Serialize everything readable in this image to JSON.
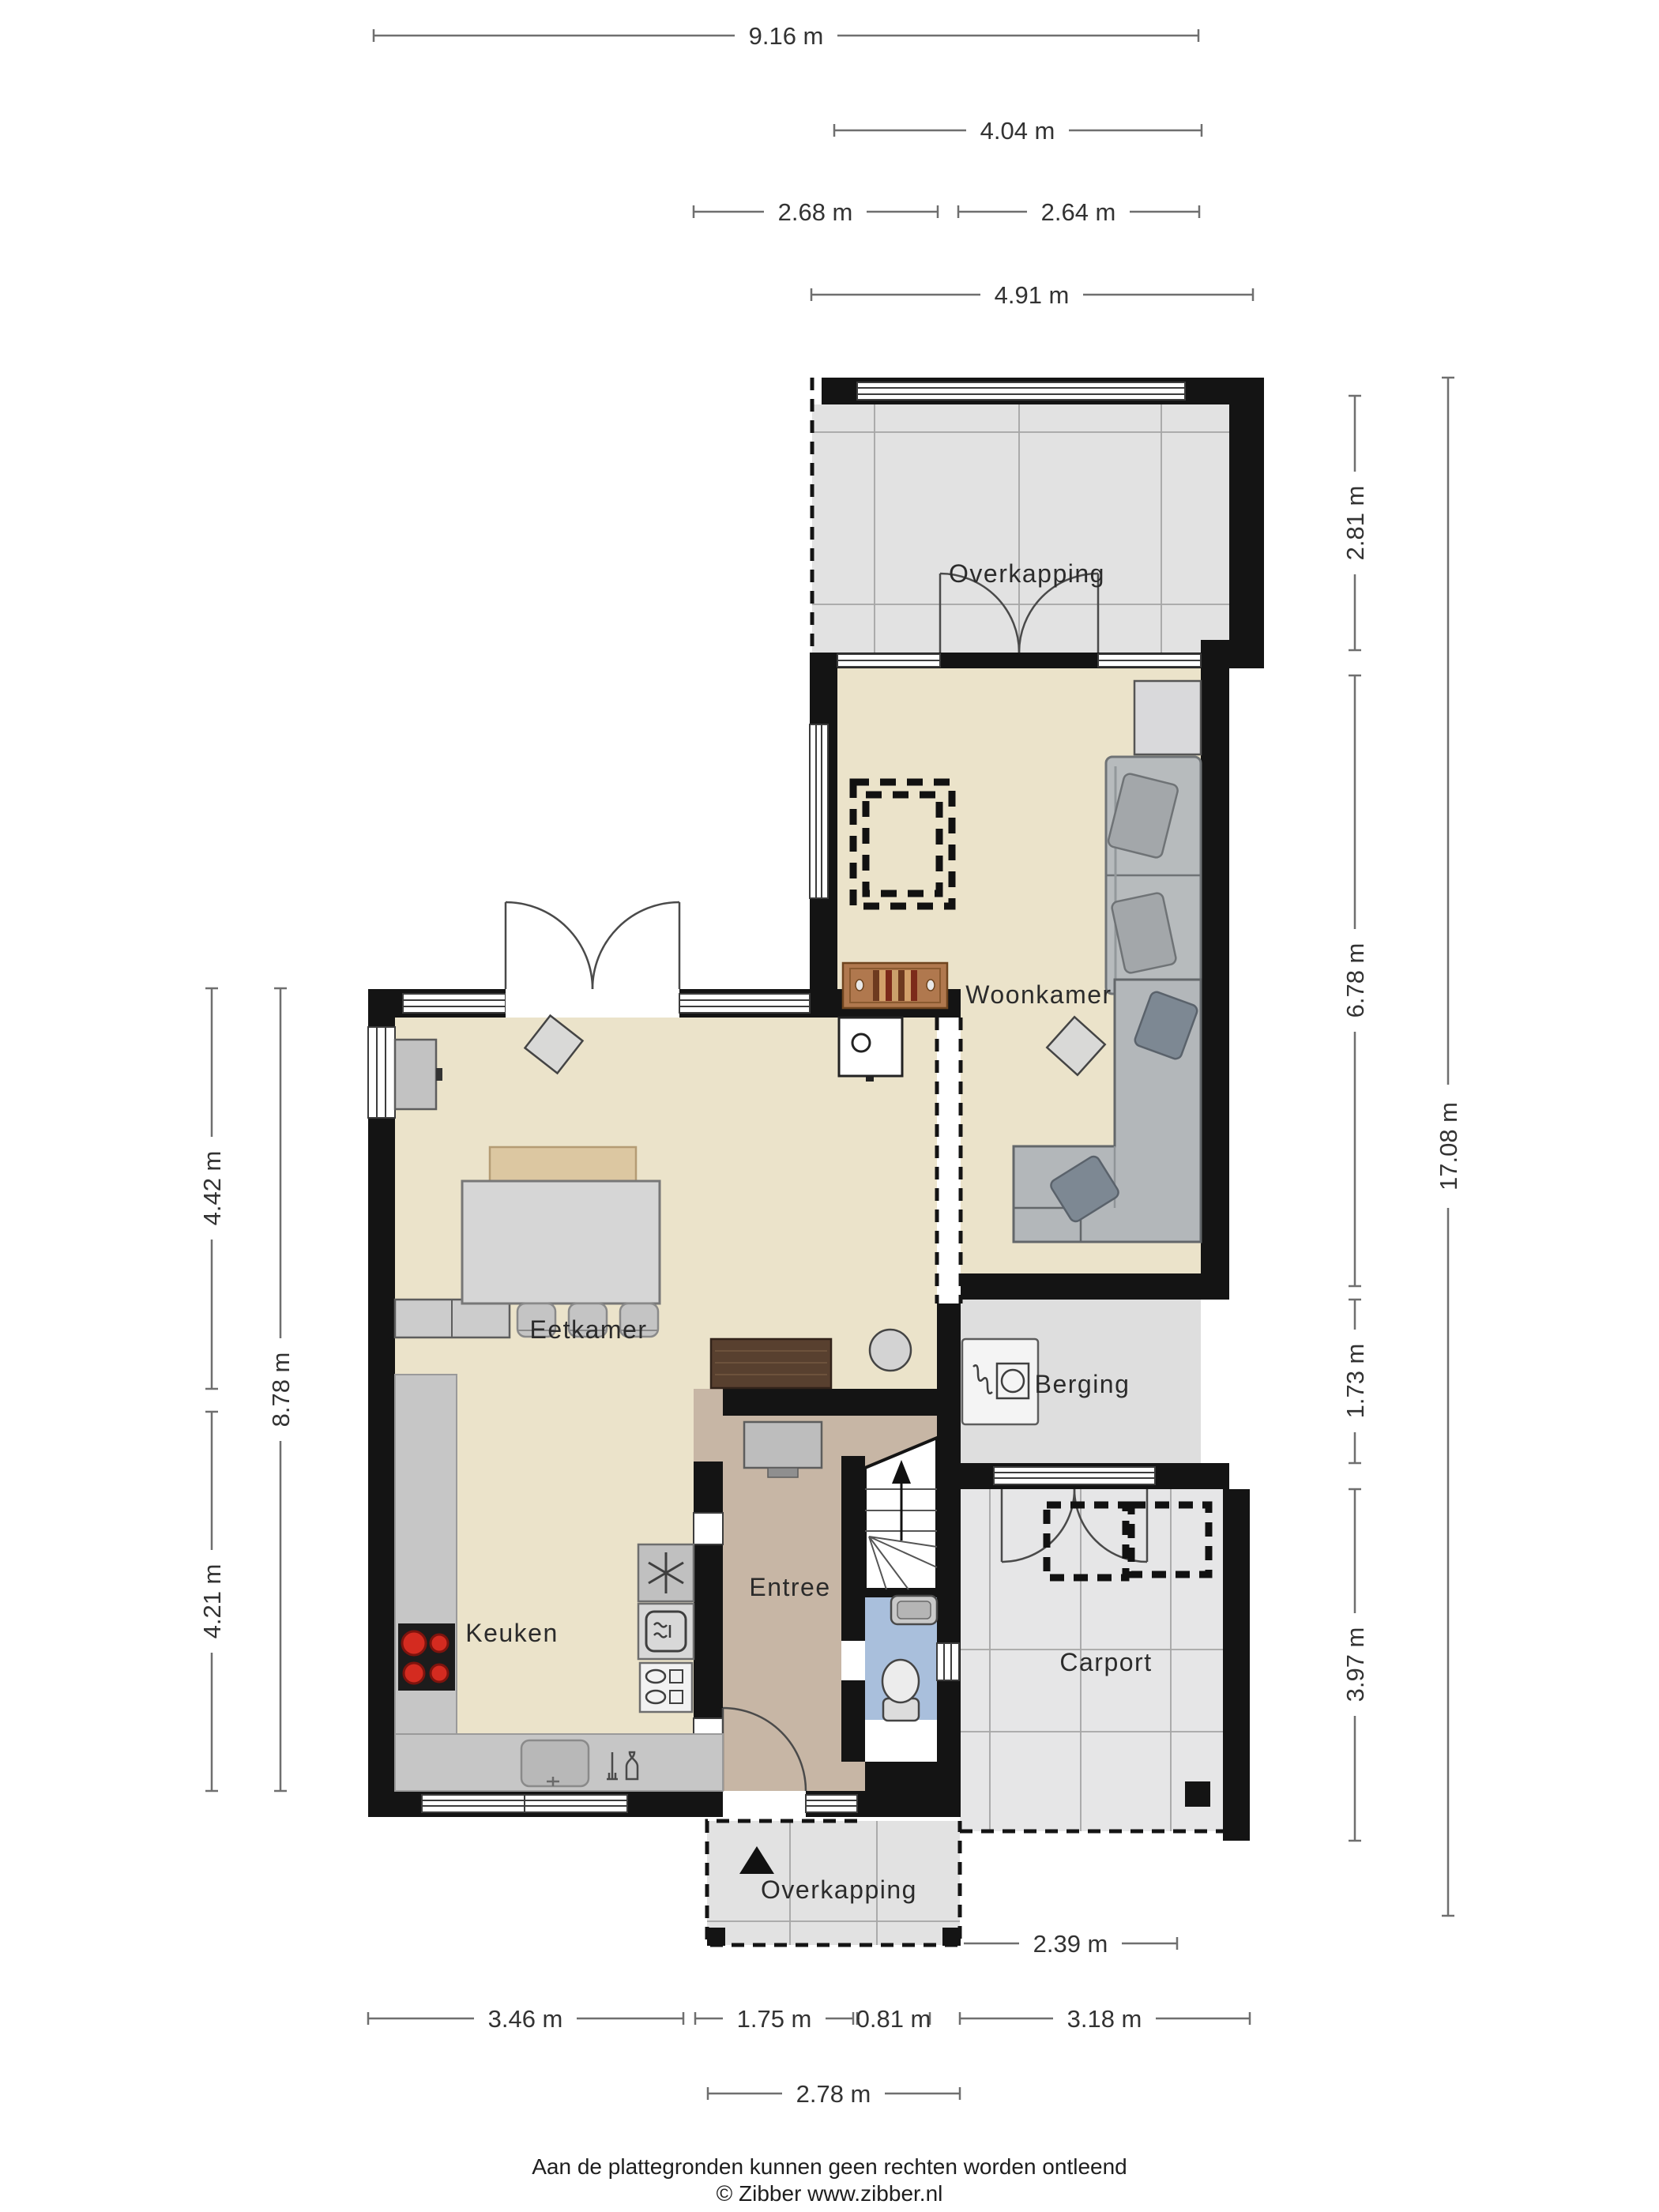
{
  "plan": {
    "type": "floorplan",
    "floor": "Begane grond",
    "rooms": {
      "overkapping_top": "Overkapping",
      "woonkamer": "Woonkamer",
      "eetkamer": "Eetkamer",
      "keuken": "Keuken",
      "entree": "Entree",
      "berging": "Berging",
      "carport": "Carport",
      "overkapping_bottom": "Overkapping"
    },
    "dimensions": {
      "top": [
        {
          "label": "9.16 m"
        },
        {
          "label": "4.04 m"
        },
        {
          "label": "2.68 m"
        },
        {
          "label": "2.64 m"
        },
        {
          "label": "4.91 m"
        }
      ],
      "right": [
        {
          "label": "2.81 m"
        },
        {
          "label": "6.78 m"
        },
        {
          "label": "1.73 m"
        },
        {
          "label": "3.97 m"
        },
        {
          "label": "17.08 m"
        }
      ],
      "left": [
        {
          "label": "4.42 m"
        },
        {
          "label": "8.78 m"
        },
        {
          "label": "4.21 m"
        }
      ],
      "bottom": [
        {
          "label": "3.46 m"
        },
        {
          "label": "1.75 m"
        },
        {
          "label": "0.81 m"
        },
        {
          "label": "3.18 m"
        },
        {
          "label": "2.78 m"
        },
        {
          "label": "2.39 m"
        }
      ]
    },
    "footer": {
      "line1": "Aan de plattegronden kunnen geen rechten worden ontleend",
      "line2": "© Zibber www.zibber.nl"
    },
    "colors": {
      "wall": "#141414",
      "living_floor": "#ebe3ca",
      "hall_floor": "#c7b6a5",
      "wc_floor": "#a9bfdc",
      "outdoor_floor": "#e2e2e2",
      "carport_floor": "#e6e6e7",
      "berging_floor": "#dedede",
      "counter": "#c6c6c6",
      "sofa": "#b7bbbd",
      "wood": "#b0784e",
      "dark_wood": "#58402f",
      "burner_red": "#d42b20"
    }
  }
}
